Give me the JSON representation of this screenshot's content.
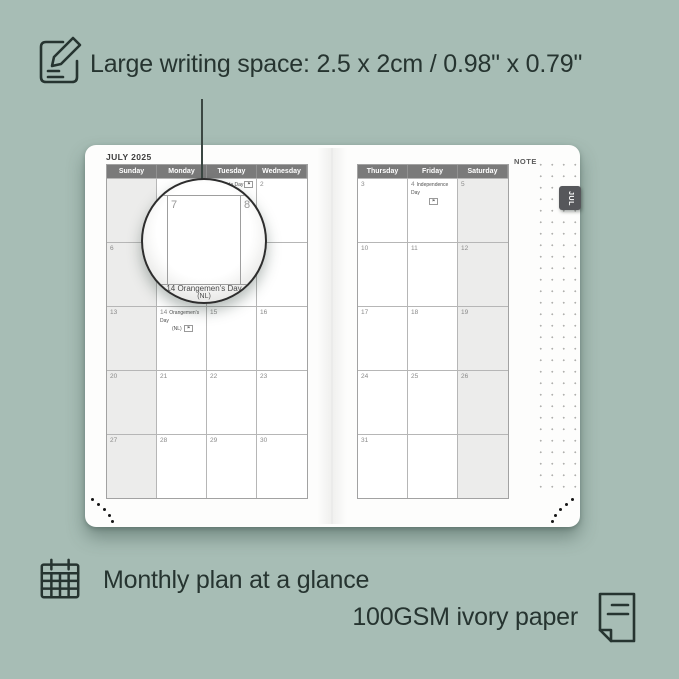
{
  "colors": {
    "background": "#a7bdb5",
    "ink": "#263430",
    "calendar_header_bg": "#7a7a7a",
    "weekend_shade": "#ececeb",
    "tab_bg": "#56575b",
    "page_bg": "#fdfdfc"
  },
  "top_caption": {
    "icon": "pencil-note-icon",
    "text": "Large writing space: 2.5 x 2cm / 0.98\" x 0.79\""
  },
  "bottom_captions": {
    "monthly": {
      "icon": "calendar-grid-icon",
      "text": "Monthly plan at a glance"
    },
    "paper": {
      "icon": "paper-sheet-icon",
      "text": "100GSM ivory paper"
    }
  },
  "planner": {
    "month_title": "JULY 2025",
    "tab_label": "JUL",
    "note_label": "NOTE",
    "left_headers": [
      "Sunday",
      "Monday",
      "Tuesday",
      "Wednesday"
    ],
    "right_headers": [
      "Thursday",
      "Friday",
      "Saturday"
    ],
    "left_rows": [
      [
        {
          "d": ""
        },
        {
          "d": ""
        },
        {
          "d": "1",
          "h": "Canada Day",
          "flag": "inline"
        },
        {
          "d": "2"
        }
      ],
      [
        {
          "d": "6"
        },
        {
          "d": "7"
        },
        {
          "d": "8"
        },
        {
          "d": "9"
        }
      ],
      [
        {
          "d": "13"
        },
        {
          "d": "14",
          "h": "Orangemen's Day",
          "h2": "(NL)",
          "flag": "line2"
        },
        {
          "d": "15"
        },
        {
          "d": "16"
        }
      ],
      [
        {
          "d": "20"
        },
        {
          "d": "21"
        },
        {
          "d": "22"
        },
        {
          "d": "23"
        }
      ],
      [
        {
          "d": "27"
        },
        {
          "d": "28"
        },
        {
          "d": "29"
        },
        {
          "d": "30"
        }
      ]
    ],
    "right_rows": [
      [
        {
          "d": "3"
        },
        {
          "d": "4",
          "h": "Independence Day",
          "flag": "below"
        },
        {
          "d": "5"
        }
      ],
      [
        {
          "d": "10"
        },
        {
          "d": "11"
        },
        {
          "d": "12"
        }
      ],
      [
        {
          "d": "17"
        },
        {
          "d": "18"
        },
        {
          "d": "19"
        }
      ],
      [
        {
          "d": "24"
        },
        {
          "d": "25"
        },
        {
          "d": "26"
        }
      ],
      [
        {
          "d": "31"
        },
        {
          "d": ""
        },
        {
          "d": ""
        }
      ]
    ],
    "shaded_left_col": 0,
    "shaded_right_col": 2,
    "flag_glyph": "⚑"
  },
  "magnifier": {
    "day_left": "7",
    "day_right": "8",
    "caption_line1": "14   Orangemen's Day",
    "caption_line2": "(NL)"
  }
}
